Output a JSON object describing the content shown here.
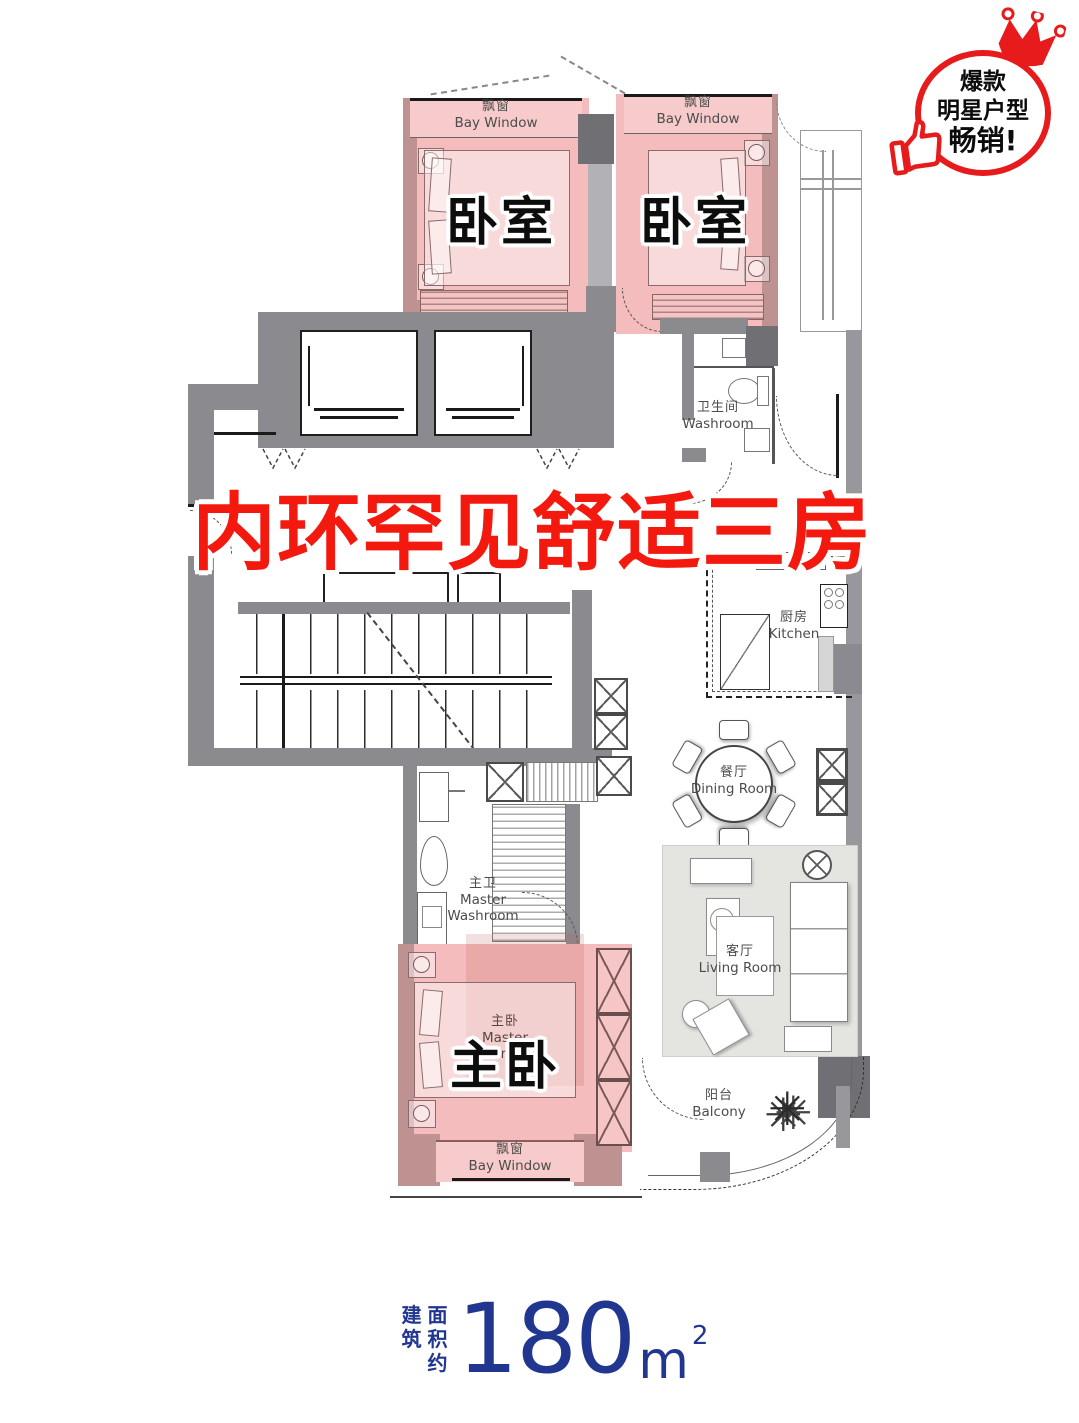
{
  "badge": {
    "line1": "爆款",
    "line2": "明星户型",
    "line3": "畅销!"
  },
  "headline": "内环罕见舒适三房",
  "labels": {
    "bedroom_zh": "卧室",
    "bay_window_zh": "飘窗",
    "bay_window_en": "Bay Window",
    "washroom_zh": "卫生间",
    "washroom_en": "Washroom",
    "kitchen_zh": "厨房",
    "kitchen_en": "Kitchen",
    "dining_zh": "餐厅",
    "dining_en": "Dining Room",
    "living_zh": "客厅",
    "living_en": "Living Room",
    "master_washroom_zh": "主卫",
    "master_washroom_en1": "Master",
    "master_washroom_en2": "Washroom",
    "master_bedroom_zh": "主卧",
    "master_bedroom_en1": "Master",
    "master_bedroom_en2": "Bedroom",
    "balcony_zh": "阳台",
    "balcony_en": "Balcony"
  },
  "area": {
    "label_col1": "建筑",
    "label_col2": "面积约",
    "value": "180",
    "unit": "m",
    "exponent": "2"
  },
  "colors": {
    "highlight_pink": "#f4bcbc",
    "accent_red": "#f4190e",
    "badge_red": "#e71a1c",
    "area_blue": "#20368f",
    "wall_gray": "#8a8a8f"
  }
}
